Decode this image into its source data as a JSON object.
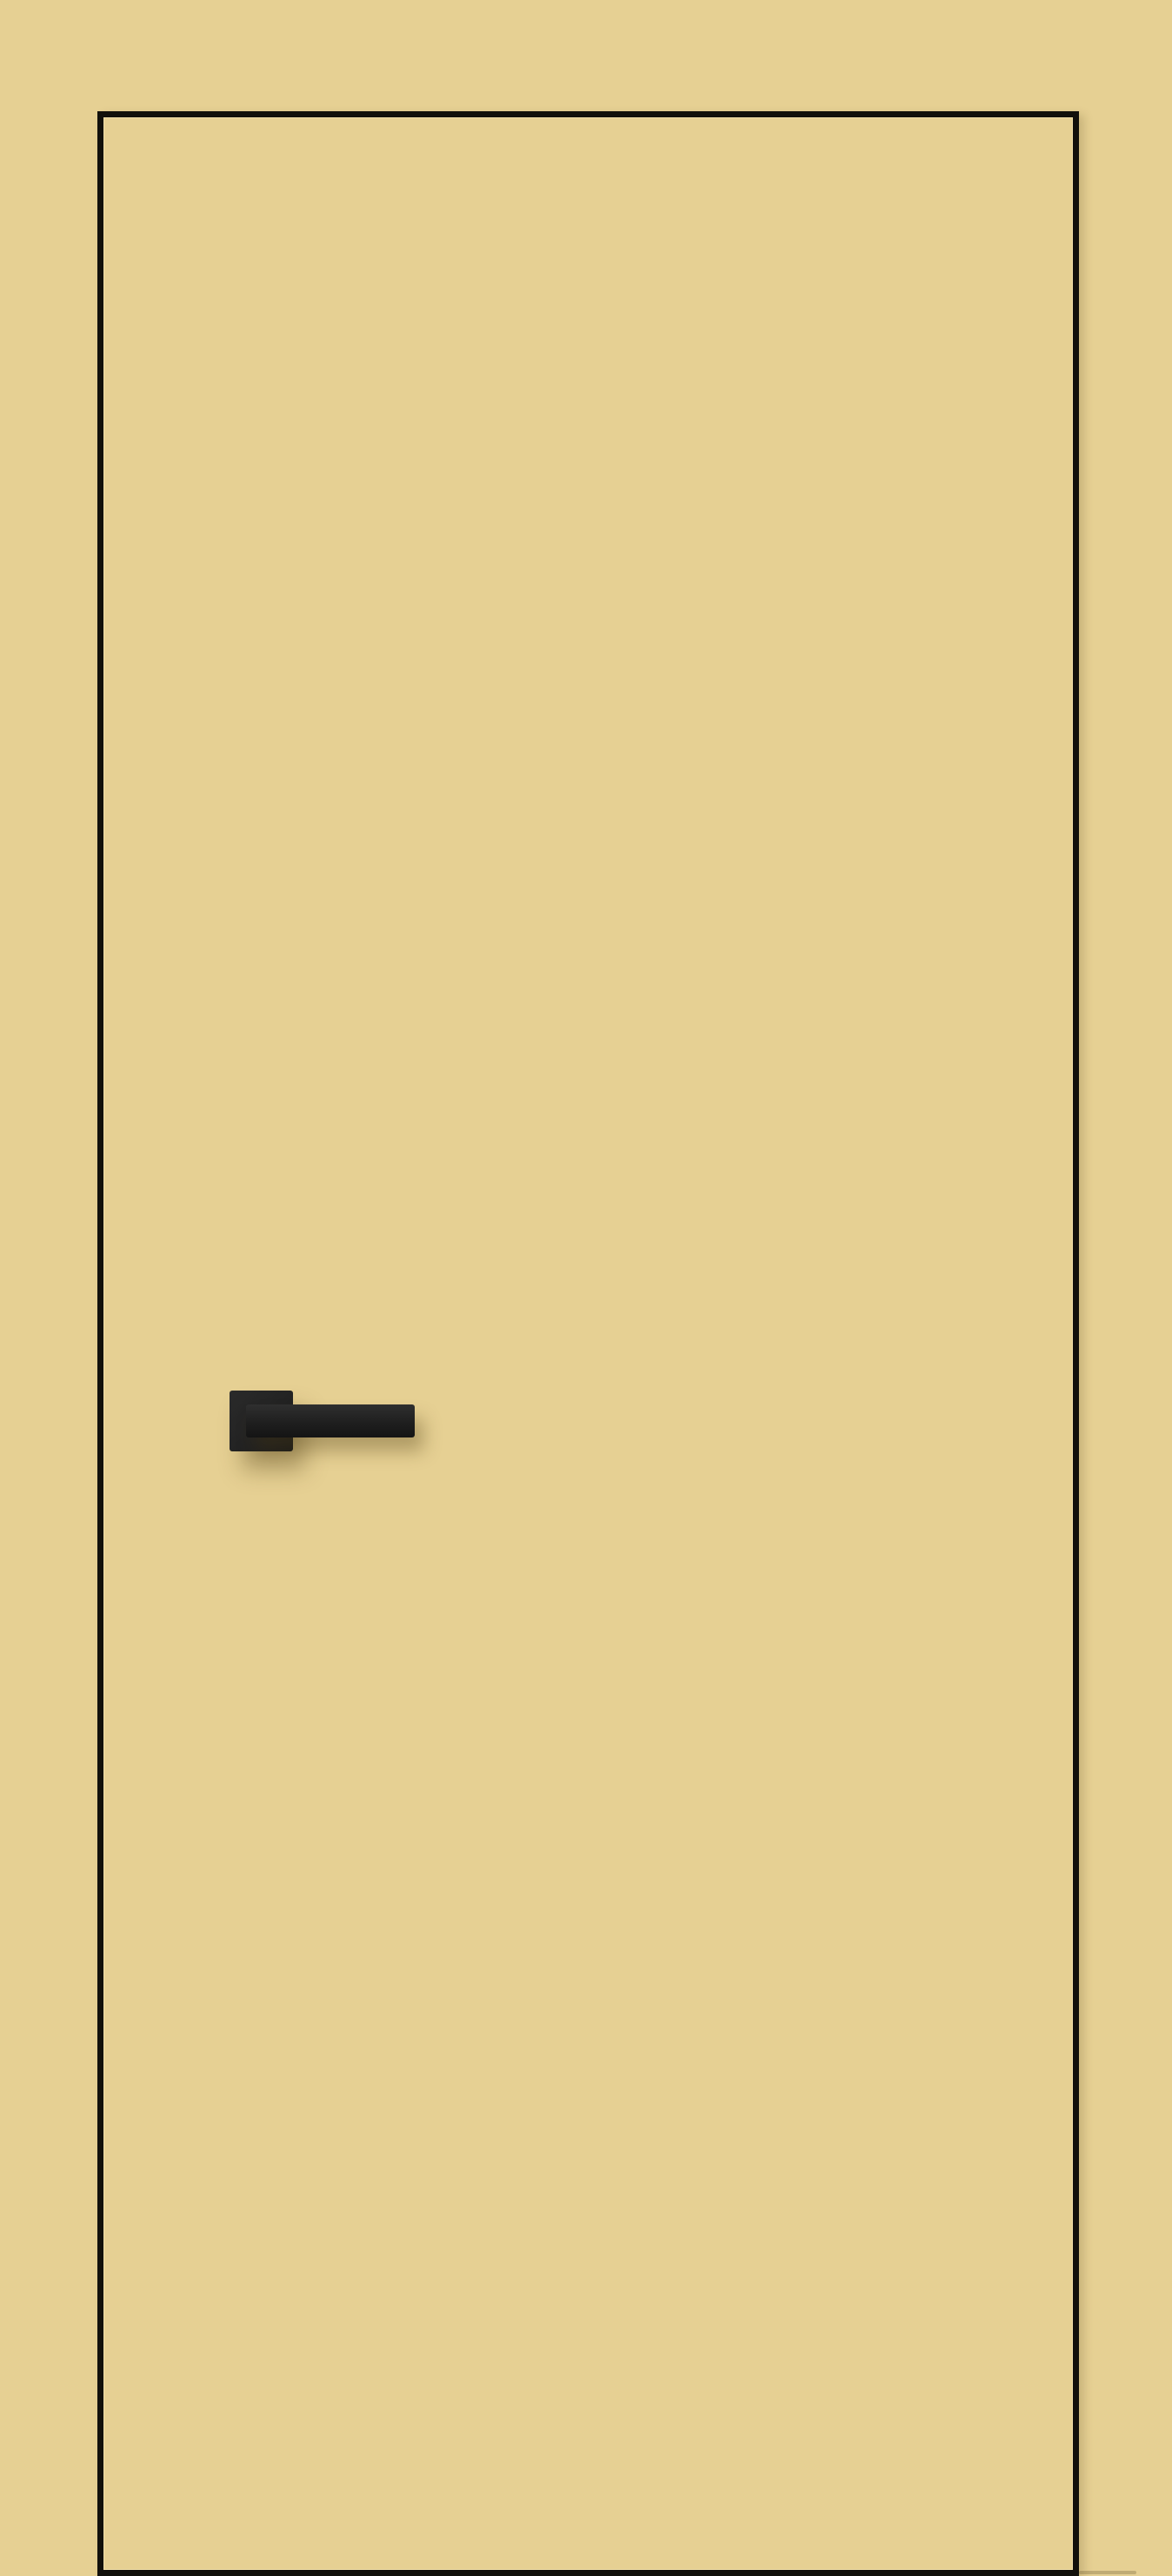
{
  "scene": {
    "kind": "product-photo",
    "subject": "flat-interior-door-leaf",
    "description": "Sand-beige flat door leaf with a thin near-black perimeter outline and a matte-black square-rosette lever handle mounted on the left side; uniform beige wall background, no visible text",
    "colors": {
      "background": "#e6d093",
      "door-face": "#e6d093",
      "outline": "#12100b",
      "outline-inner-highlight": "rgba(248,233,187,0.55)",
      "rosette": "#242424",
      "lever": "#1f1f1f",
      "lever-highlight": "#2f2f2f",
      "handle-shadow": "rgba(74,57,18,0.35)",
      "edge-shadow": "rgba(74,57,18,0.18)"
    },
    "layout": {
      "canvas-width": 1348,
      "canvas-height": 2964,
      "door-left": 112,
      "door-top": 128,
      "door-width": 1129,
      "door-height": 2836,
      "outline-thickness": 7,
      "rosette-left": 145,
      "rosette-top": 1465,
      "rosette-width": 73,
      "rosette-height": 70,
      "rosette-radius": 3,
      "lever-left": 164,
      "lever-top": 1481,
      "lever-width": 194,
      "lever-height": 38,
      "lever-radius": 3
    }
  }
}
